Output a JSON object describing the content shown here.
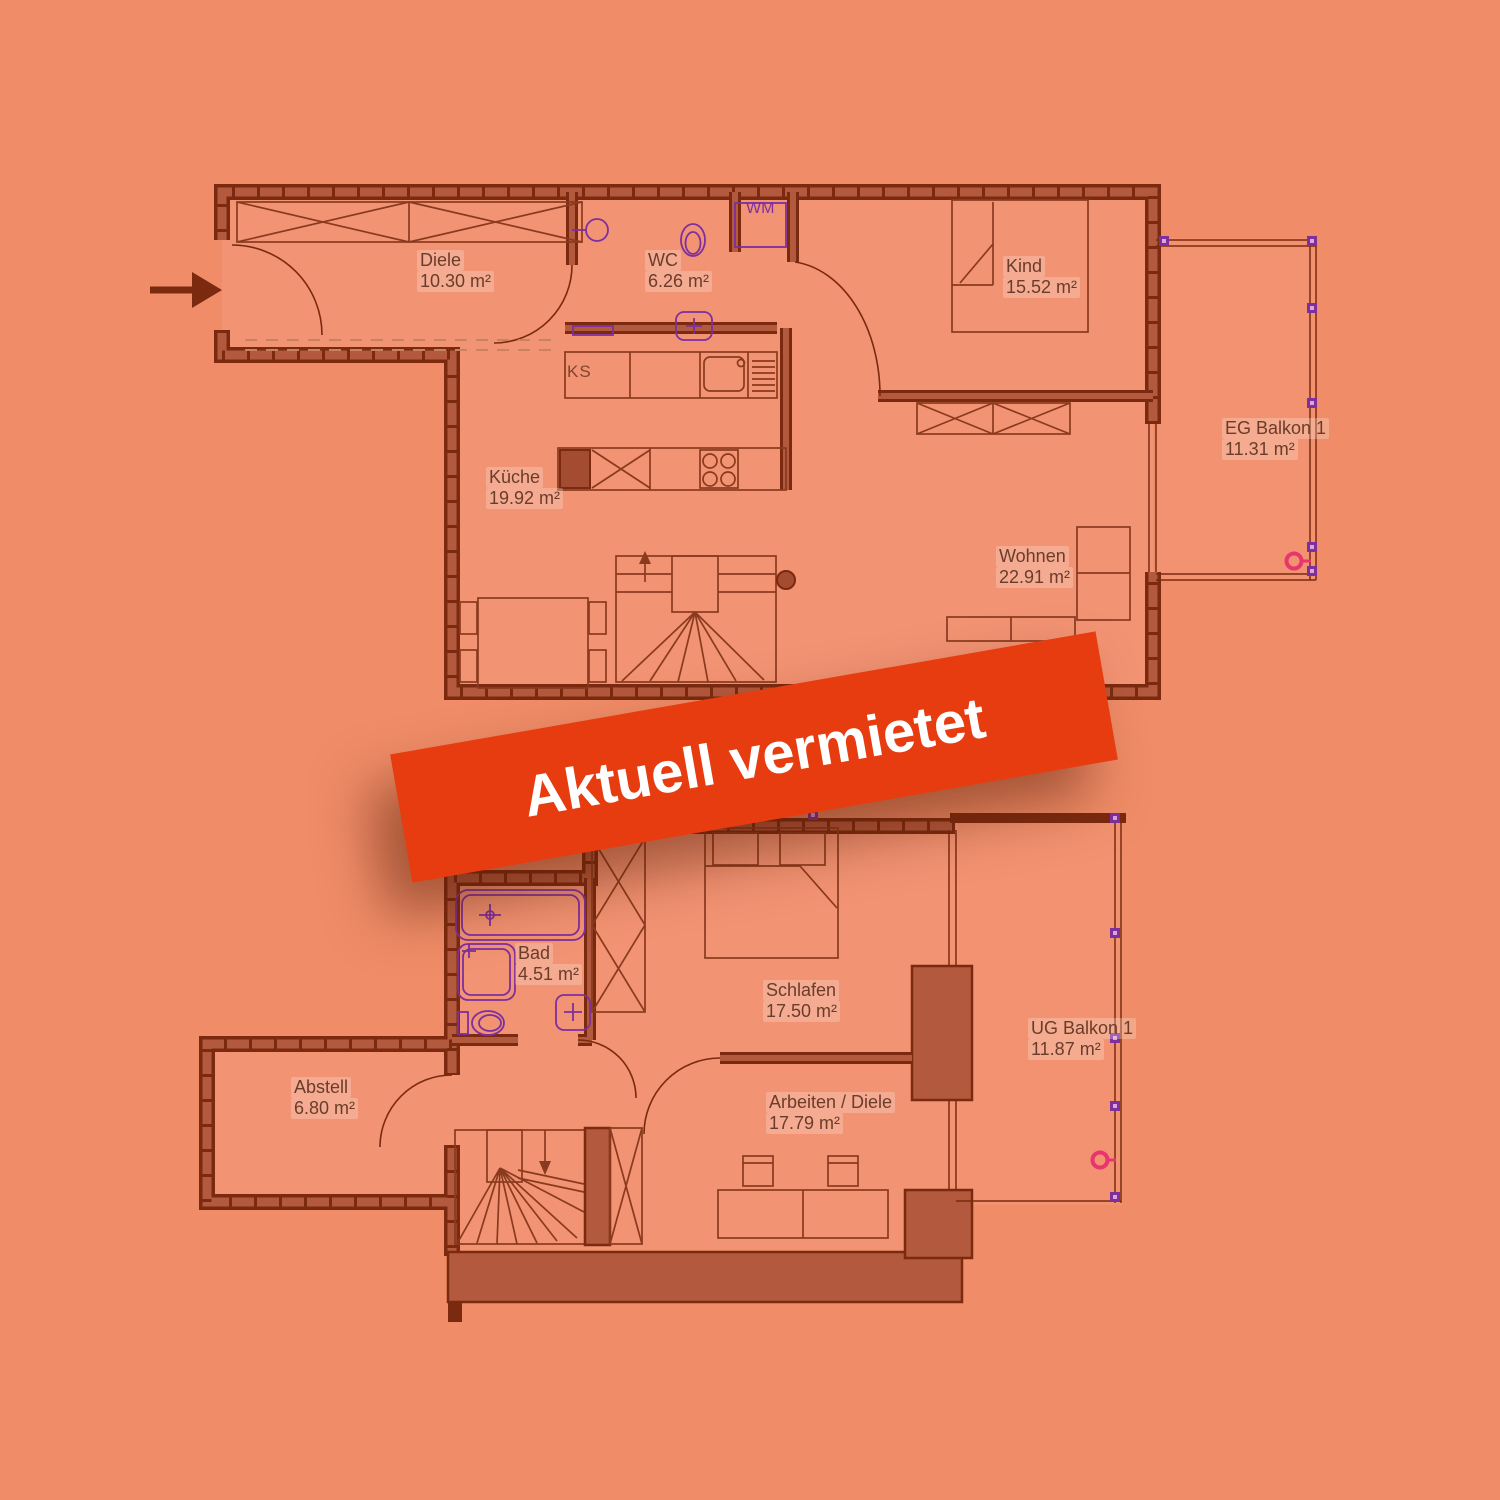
{
  "banner": {
    "label": "Aktuell vermietet"
  },
  "floors": {
    "eg": {
      "rooms": {
        "diele": {
          "name": "Diele",
          "area": "10.30 m²"
        },
        "wc": {
          "name": "WC",
          "area": "6.26 m²"
        },
        "kind": {
          "name": "Kind",
          "area": "15.52 m²"
        },
        "kueche": {
          "name": "Küche",
          "area": "19.92 m²"
        },
        "wohnen": {
          "name": "Wohnen",
          "area": "22.91 m²"
        },
        "balkon": {
          "name": "EG Balkon 1",
          "area": "11.31 m²"
        }
      },
      "appliances": {
        "wm": "WM",
        "ks": "KS"
      }
    },
    "ug": {
      "rooms": {
        "bad": {
          "name": "Bad",
          "area": "4.51 m²"
        },
        "schlafen": {
          "name": "Schlafen",
          "area": "17.50 m²"
        },
        "abstell": {
          "name": "Abstell",
          "area": "6.80 m²"
        },
        "arbeiten": {
          "name": "Arbeiten / Diele",
          "area": "17.79 m²"
        },
        "balkon": {
          "name": "UG Balkon 1",
          "area": "11.87 m²"
        }
      }
    }
  },
  "colors": {
    "background": "#f08d68",
    "wall": "#b3593d",
    "wall_outline": "#7b2a0f",
    "fixture_purple": "#7d2f9e",
    "marker_pink": "#e8356f",
    "banner_red": "#e73c10",
    "label_text": "#6b3c2a"
  }
}
